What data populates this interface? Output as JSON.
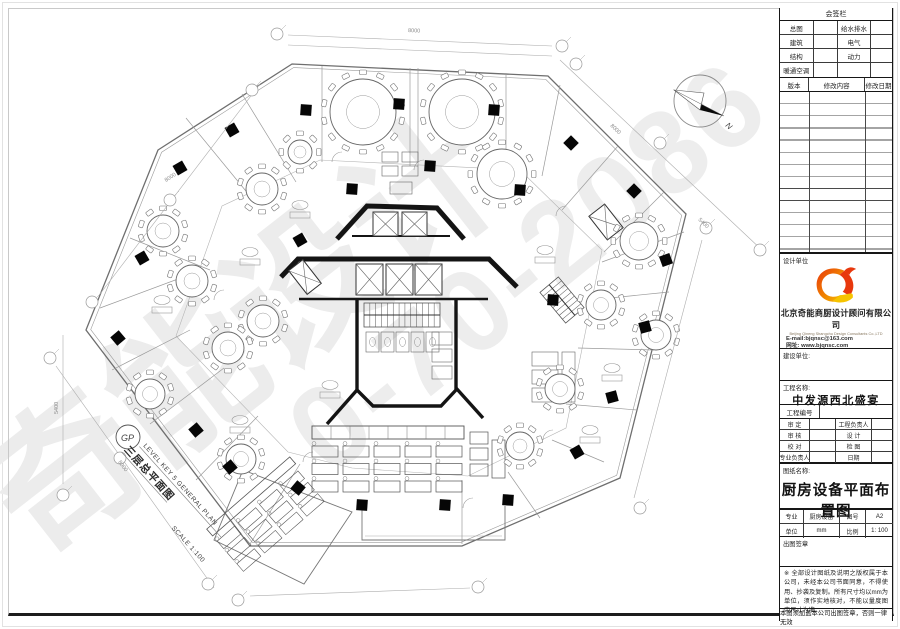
{
  "sheet": {
    "signature": {
      "title": "会签栏",
      "rows": [
        {
          "l": "总图",
          "r": "给水排水"
        },
        {
          "l": "建筑",
          "r": "电气"
        },
        {
          "l": "结构",
          "r": "动力"
        },
        {
          "l": "暖通空调",
          "r": ""
        }
      ],
      "rev_cols": {
        "c0": "版本",
        "c1": "修改内容",
        "c2": "修改日期"
      }
    },
    "design_unit_label": "设计单位",
    "company": {
      "cn": "北京奇能商厨设计顾问有限公司",
      "en": "Beijing Qineng Shangchu  Design  Consultants Co.,LTD",
      "email": "E-mail:bjqnsc@163.com",
      "site": "网址: www.bjqnsc.com"
    },
    "build_unit_label": "建设单位:",
    "project": {
      "name_label": "工程名称:",
      "name": "中发源西北盛宴",
      "no_label": "工程编号"
    },
    "personnel": {
      "r0": {
        "l": "审 定",
        "r": "工程负责人"
      },
      "r1": {
        "l": "审 核",
        "r": "设 计"
      },
      "r2": {
        "l": "校 对",
        "r": "检 图"
      },
      "r3": {
        "l": "专业负责人",
        "r": "日期"
      }
    },
    "drawing": {
      "label": "图纸名称:",
      "name": "厨房设备平面布置图"
    },
    "spec": {
      "r0": {
        "c0": "专业",
        "c1": "厨房设备",
        "c2": "图号",
        "c3": "A2"
      },
      "r1": {
        "c0": "单位",
        "c1": "mm",
        "c2": "比例",
        "c3": "1: 100"
      }
    },
    "seal_label": "出图签章",
    "disclaimer": "※ 全部设计图纸及说明之版权属于本公司，未经本公司书面同意，不得使用、抄袭及复制。所有尺寸均以mm为单位，须作实地核对，不能以量度图中尺寸为准。",
    "validity": "本图须加盖本公司出图签章，否则一律无效"
  },
  "plan": {
    "title_en": "LEVEL KEY 5 GENERAL PLAN",
    "title_cn": "三层总平面图",
    "scale": "SCALE 1:100",
    "north": "N",
    "key_symbol": "GP",
    "watermark_text": "奇能设计",
    "watermark_number": "0-70-2086",
    "dims": {
      "d0": "8000",
      "d1": "8000",
      "d2": "5400",
      "d3": "8000",
      "d4": "5400",
      "d5": "8000"
    }
  }
}
